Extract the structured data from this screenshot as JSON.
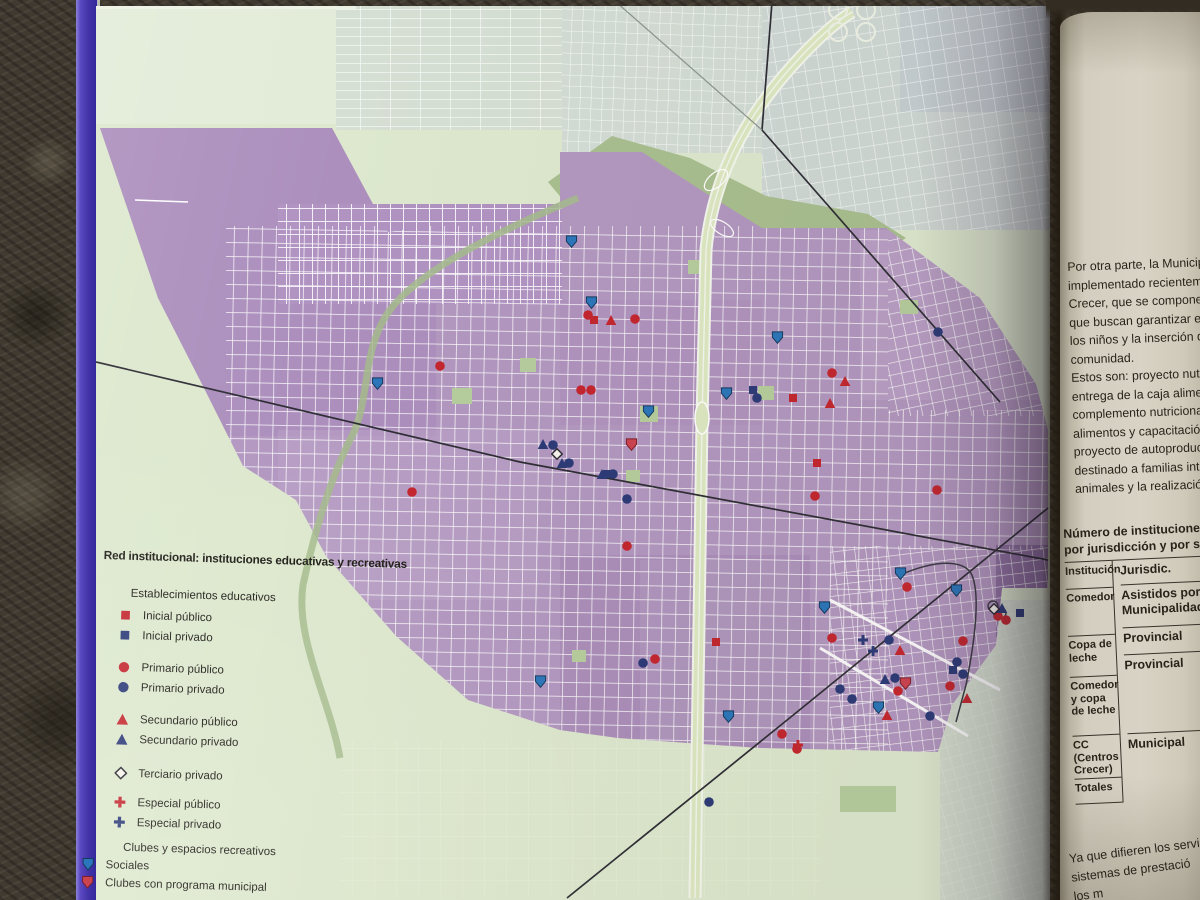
{
  "palette": {
    "spine": "#4334a8",
    "map_page_green": "#dde8ce",
    "urban_purple": "#b297c0",
    "river_green": "#a9bf90",
    "right_page_beige": "#d5cfc0",
    "red": "#c4262f",
    "navy": "#2c3a78",
    "blue_shield": "#2b76ba",
    "red_shield": "#cc4350",
    "ink": "#262219"
  },
  "legend": {
    "title": "Red institucional: instituciones educativas y recreativas",
    "rows": [
      {
        "kind": "header",
        "label": "Establecimientos educativos"
      },
      {
        "kind": "item",
        "icon": "sq_r",
        "label": "Inicial público"
      },
      {
        "kind": "item",
        "icon": "sq_n",
        "label": "Inicial privado"
      },
      {
        "kind": "item",
        "icon": "ci_r",
        "label": "Primario público"
      },
      {
        "kind": "item",
        "icon": "ci_n",
        "label": "Primario privado"
      },
      {
        "kind": "item",
        "icon": "tr_r",
        "label": "Secundario público"
      },
      {
        "kind": "item",
        "icon": "tr_n",
        "label": "Secundario privado"
      },
      {
        "kind": "item",
        "icon": "di",
        "label": "Terciario privado"
      },
      {
        "kind": "item",
        "icon": "cr_r",
        "label": "Especial público"
      },
      {
        "kind": "item",
        "icon": "cr_n",
        "label": "Especial privado"
      },
      {
        "kind": "header",
        "label": "Clubes y espacios recreativos"
      },
      {
        "kind": "item",
        "icon": "sh_b",
        "label": "Sociales",
        "club": true
      },
      {
        "kind": "item",
        "icon": "sh_r",
        "label": "Clubes con programa municipal",
        "club": true
      }
    ]
  },
  "marker_types": {
    "sq_r": "inicial-publico",
    "sq_n": "inicial-privado",
    "ci_r": "primario-publico",
    "ci_n": "primario-privado",
    "tr_r": "secundario-publico",
    "tr_n": "secundario-privado",
    "di": "terciario-privado",
    "cr_r": "especial-publico",
    "cr_n": "especial-privado",
    "sh_b": "club-social",
    "sh_r": "club-programa-municipal"
  },
  "map": {
    "markers": [
      [
        "sq_r",
        594,
        319
      ],
      [
        "sq_r",
        793,
        397
      ],
      [
        "sq_r",
        817,
        462
      ],
      [
        "sq_r",
        716,
        641
      ],
      [
        "sq_n",
        753,
        389
      ],
      [
        "sq_n",
        607,
        473
      ],
      [
        "sq_n",
        953,
        669
      ],
      [
        "sq_n",
        1020,
        612
      ],
      [
        "ci_r",
        588,
        314
      ],
      [
        "ci_r",
        635,
        318
      ],
      [
        "ci_r",
        581,
        389
      ],
      [
        "ci_r",
        591,
        389
      ],
      [
        "ci_r",
        832,
        372
      ],
      [
        "ci_r",
        815,
        495
      ],
      [
        "ci_r",
        412,
        491
      ],
      [
        "ci_r",
        440,
        365
      ],
      [
        "ci_r",
        627,
        545
      ],
      [
        "ci_r",
        655,
        658
      ],
      [
        "ci_r",
        832,
        637
      ],
      [
        "ci_r",
        963,
        640
      ],
      [
        "ci_r",
        950,
        685
      ],
      [
        "ci_r",
        898,
        690
      ],
      [
        "ci_r",
        998,
        615
      ],
      [
        "ci_r",
        1006,
        619
      ],
      [
        "ci_r",
        907,
        586
      ],
      [
        "ci_r",
        782,
        733
      ],
      [
        "ci_r",
        797,
        748
      ],
      [
        "ci_r",
        937,
        489
      ],
      [
        "ci_n",
        757,
        397
      ],
      [
        "ci_n",
        553,
        444
      ],
      [
        "ci_n",
        569,
        462
      ],
      [
        "ci_n",
        613,
        473
      ],
      [
        "ci_n",
        627,
        498
      ],
      [
        "ci_n",
        709,
        801
      ],
      [
        "ci_n",
        889,
        639
      ],
      [
        "ci_n",
        895,
        677
      ],
      [
        "ci_n",
        963,
        673
      ],
      [
        "ci_n",
        840,
        688
      ],
      [
        "ci_n",
        852,
        698
      ],
      [
        "ci_n",
        930,
        715
      ],
      [
        "ci_n",
        957,
        661
      ],
      [
        "ci_n",
        643,
        662
      ],
      [
        "ci_n",
        938,
        331
      ],
      [
        "tr_r",
        611,
        319
      ],
      [
        "tr_r",
        845,
        380
      ],
      [
        "tr_r",
        830,
        402
      ],
      [
        "tr_r",
        900,
        649
      ],
      [
        "tr_r",
        887,
        714
      ],
      [
        "tr_r",
        967,
        697
      ],
      [
        "tr_n",
        543,
        443
      ],
      [
        "tr_n",
        562,
        462
      ],
      [
        "tr_n",
        602,
        473
      ],
      [
        "tr_n",
        885,
        678
      ],
      [
        "tr_n",
        1002,
        607
      ],
      [
        "di",
        557,
        453
      ],
      [
        "di",
        994,
        608
      ],
      [
        "cr_r",
        798,
        744
      ],
      [
        "cr_n",
        863,
        639
      ],
      [
        "cr_n",
        873,
        650
      ],
      [
        "sh_b",
        591,
        302
      ],
      [
        "sh_b",
        777,
        337
      ],
      [
        "sh_b",
        726,
        393
      ],
      [
        "sh_b",
        648,
        411
      ],
      [
        "sh_b",
        377,
        383
      ],
      [
        "sh_b",
        571,
        241
      ],
      [
        "sh_b",
        900,
        573
      ],
      [
        "sh_b",
        824,
        607
      ],
      [
        "sh_b",
        956,
        590
      ],
      [
        "sh_b",
        878,
        707
      ],
      [
        "sh_b",
        728,
        716
      ],
      [
        "sh_b",
        540,
        681
      ],
      [
        "sh_r",
        631,
        444
      ],
      [
        "sh_r",
        905,
        683
      ]
    ]
  },
  "right_page": {
    "paragraph_lines": [
      "Por otra parte, la Municipa",
      "implementado recientemen",
      "Crecer, que se compone de",
      "que buscan garantizar el de",
      "los niños y la inserción de l",
      "comunidad.",
      "Estos son: proyecto nutricio",
      "entrega de la caja alimenta",
      "complemento nutricional, la",
      "alimentos y capacitación a c",
      "proyecto de autoproducción",
      "destinado a familias interes",
      "animales y la realización de"
    ],
    "table": {
      "title_lines": [
        "Número de instituciones",
        "por jurisdicción y por sec"
      ],
      "left_rows": [
        "Institución",
        "Comedor",
        "Copa de leche",
        "Comedor y copa de leche",
        "CC (Centros Crecer)",
        "Totales"
      ],
      "right_rows": [
        "Jurisdic.",
        "Asistidos por Municipalidad",
        "Provincial",
        "Provincial",
        "Municipal"
      ]
    },
    "bottom_lines": [
      "Ya que difieren los servicios b",
      "sistemas de prestació",
      "los m"
    ]
  }
}
